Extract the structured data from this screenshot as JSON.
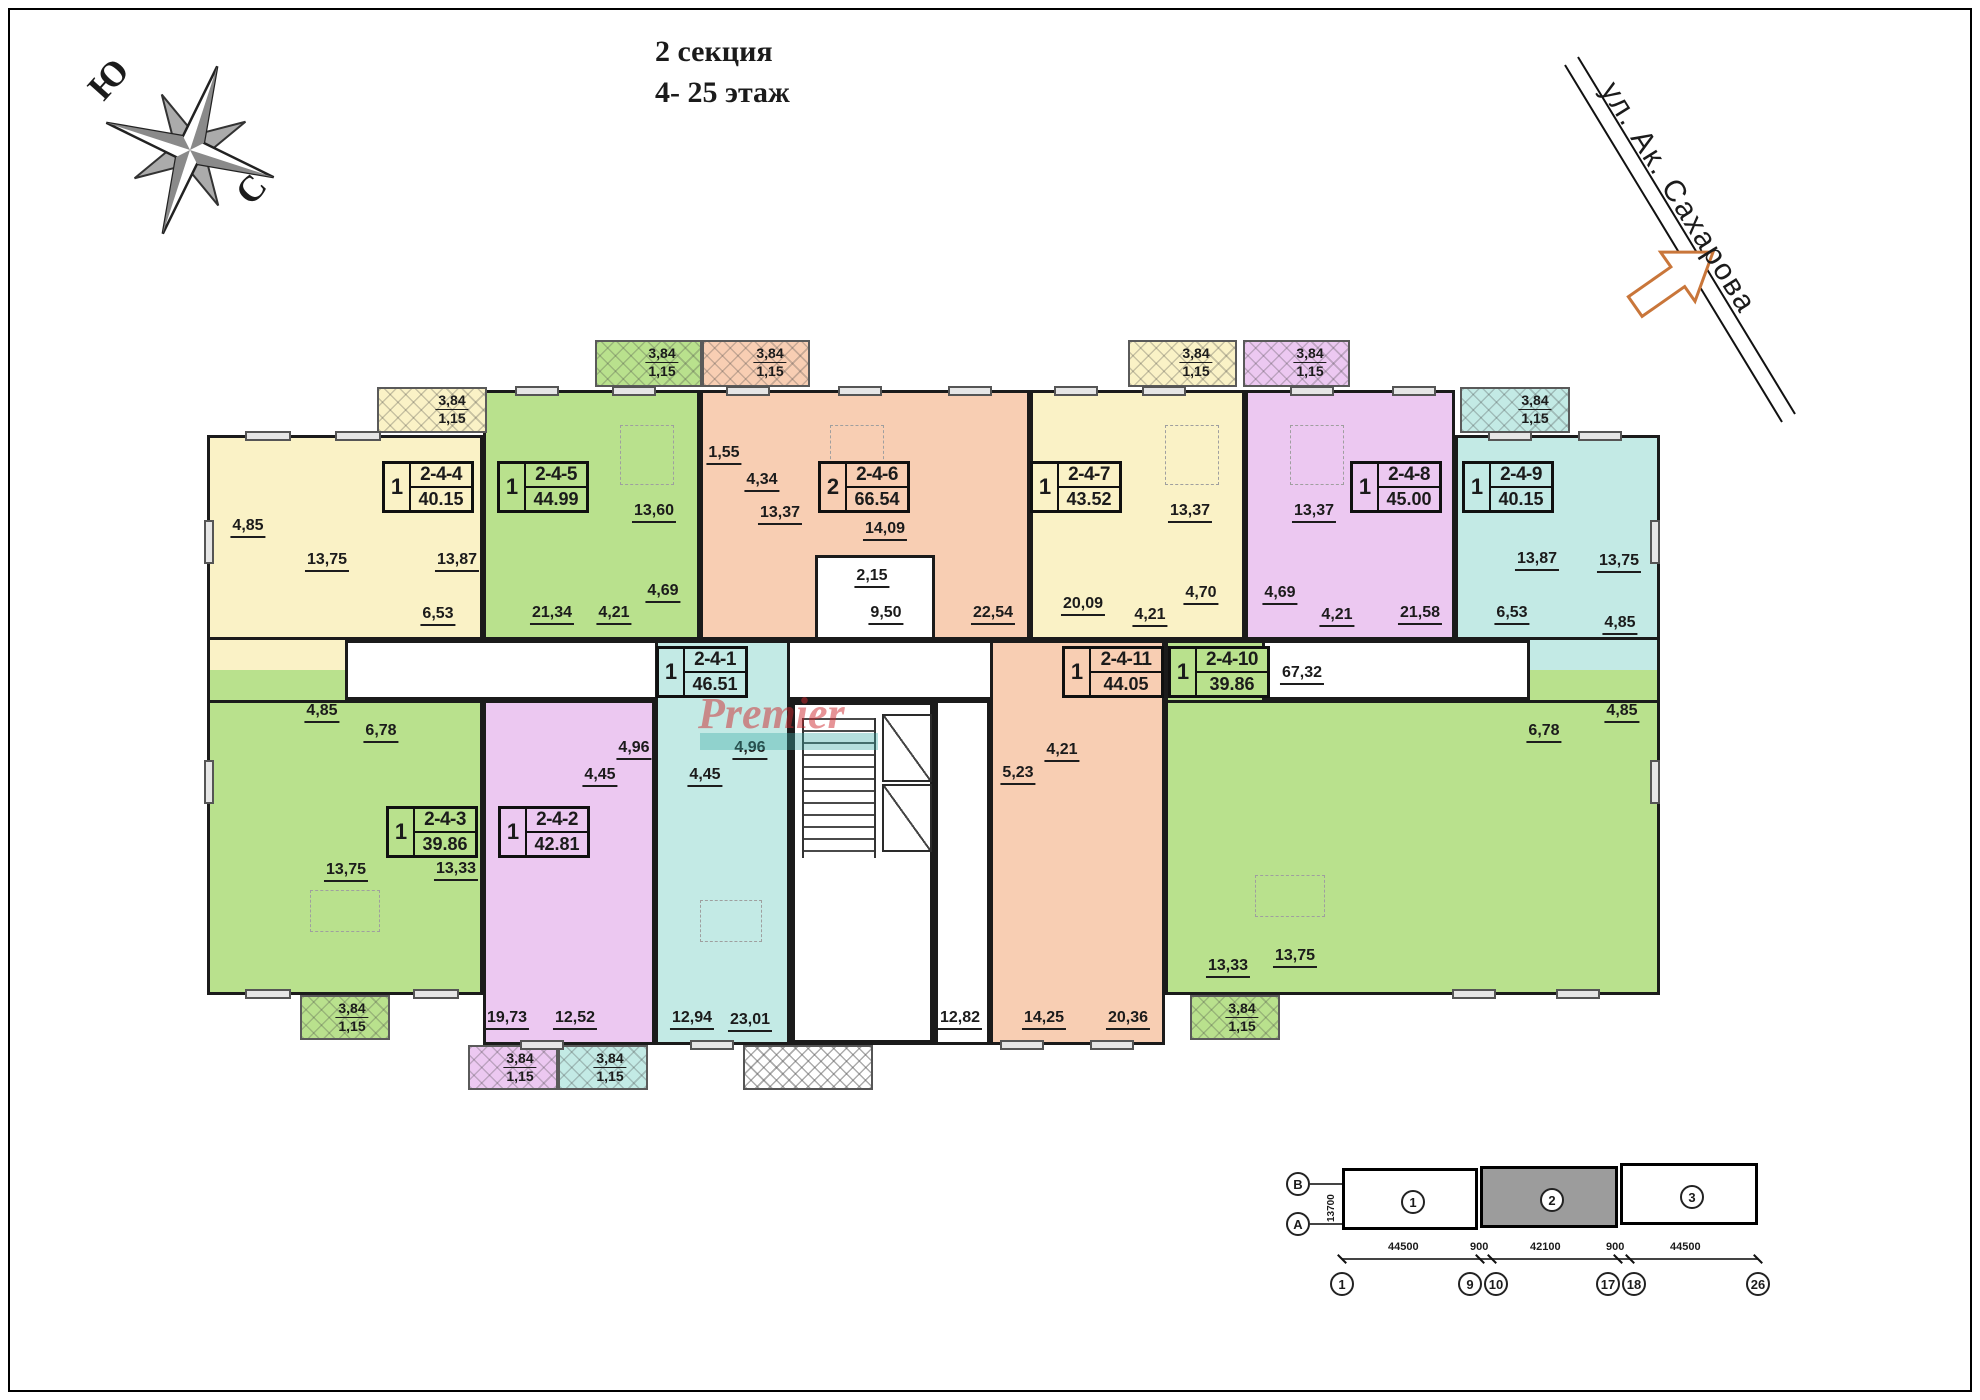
{
  "title": {
    "line1": "2 секция",
    "line2": "4- 25 этаж"
  },
  "compass": {
    "south_label": "Ю",
    "north_label": "С"
  },
  "street": {
    "name": "ул. Ак. Сахарова"
  },
  "watermark": {
    "text": "Premier"
  },
  "colors": {
    "yellow": "#FAF2C6",
    "green": "#B9E18D",
    "salmon": "#F8CEB3",
    "purple": "#ECC8F1",
    "cyan": "#C3EAE5",
    "wall": "#1B1B1B",
    "street_arrow": "#C9763A",
    "keyplan_highlight": "#9C9C9C",
    "watermark_red": "#CD282D",
    "watermark_teal": "#3CAAA5"
  },
  "balcony": {
    "area": "3,84",
    "reduced": "1,15"
  },
  "common": {
    "corridor_area": "67,32",
    "lobby_area": "2,15",
    "vestibule_area": "12,82"
  },
  "apartments": [
    {
      "id": "2-4-4",
      "rooms_count": "1",
      "total_area": "40.15",
      "color_name": "yellow",
      "rooms": [
        {
          "area": "13,75"
        },
        {
          "area": "13,87"
        },
        {
          "area": "4,85"
        },
        {
          "area": "6,53"
        }
      ]
    },
    {
      "id": "2-4-5",
      "rooms_count": "1",
      "total_area": "44.99",
      "color_name": "green",
      "rooms": [
        {
          "area": "13,60"
        },
        {
          "area": "21,34"
        },
        {
          "area": "4,21"
        },
        {
          "area": "4,69"
        }
      ]
    },
    {
      "id": "2-4-6",
      "rooms_count": "2",
      "total_area": "66.54",
      "color_name": "salmon",
      "rooms": [
        {
          "area": "13,37"
        },
        {
          "area": "14,09"
        },
        {
          "area": "1,55"
        },
        {
          "area": "4,34"
        },
        {
          "area": "9,50"
        },
        {
          "area": "22,54"
        }
      ]
    },
    {
      "id": "2-4-7",
      "rooms_count": "1",
      "total_area": "43.52",
      "color_name": "yellow",
      "rooms": [
        {
          "area": "13,37"
        },
        {
          "area": "20,09"
        },
        {
          "area": "4,21"
        },
        {
          "area": "4,70"
        }
      ]
    },
    {
      "id": "2-4-8",
      "rooms_count": "1",
      "total_area": "45.00",
      "color_name": "purple",
      "rooms": [
        {
          "area": "13,37"
        },
        {
          "area": "4,69"
        },
        {
          "area": "4,21"
        },
        {
          "area": "21,58"
        }
      ]
    },
    {
      "id": "2-4-9",
      "rooms_count": "1",
      "total_area": "40.15",
      "color_name": "cyan",
      "rooms": [
        {
          "area": "13,87"
        },
        {
          "area": "13,75"
        },
        {
          "area": "6,53"
        },
        {
          "area": "4,85"
        }
      ]
    },
    {
      "id": "2-4-3",
      "rooms_count": "1",
      "total_area": "39.86",
      "color_name": "green",
      "rooms": [
        {
          "area": "13,75"
        },
        {
          "area": "13,33"
        },
        {
          "area": "4,85"
        },
        {
          "area": "6,78"
        }
      ]
    },
    {
      "id": "2-4-2",
      "rooms_count": "1",
      "total_area": "42.81",
      "color_name": "purple",
      "rooms": [
        {
          "area": "19,73"
        },
        {
          "area": "12,52"
        },
        {
          "area": "4,45"
        },
        {
          "area": "4,96"
        }
      ]
    },
    {
      "id": "2-4-1",
      "rooms_count": "1",
      "total_area": "46.51",
      "color_name": "cyan",
      "rooms": [
        {
          "area": "12,94"
        },
        {
          "area": "23,01"
        },
        {
          "area": "4,96"
        },
        {
          "area": "4,45"
        }
      ]
    },
    {
      "id": "2-4-11",
      "rooms_count": "1",
      "total_area": "44.05",
      "color_name": "salmon",
      "rooms": [
        {
          "area": "5,23"
        },
        {
          "area": "4,21"
        },
        {
          "area": "14,25"
        },
        {
          "area": "20,36"
        }
      ]
    },
    {
      "id": "2-4-10",
      "rooms_count": "1",
      "total_area": "39.86",
      "color_name": "green",
      "rooms": [
        {
          "area": "13,33"
        },
        {
          "area": "13,75"
        },
        {
          "area": "4,85"
        },
        {
          "area": "6,78"
        }
      ]
    }
  ],
  "keyplan": {
    "axis_row_letters": [
      "В",
      "А"
    ],
    "section_depth_dim": "13700",
    "blocks": [
      {
        "num": "1"
      },
      {
        "num": "2"
      },
      {
        "num": "3"
      }
    ],
    "highlighted_block": "2",
    "dims": [
      "44500",
      "900",
      "42100",
      "900",
      "44500"
    ],
    "axis_numbers": [
      "1",
      "9",
      "10",
      "17",
      "18",
      "26"
    ]
  }
}
